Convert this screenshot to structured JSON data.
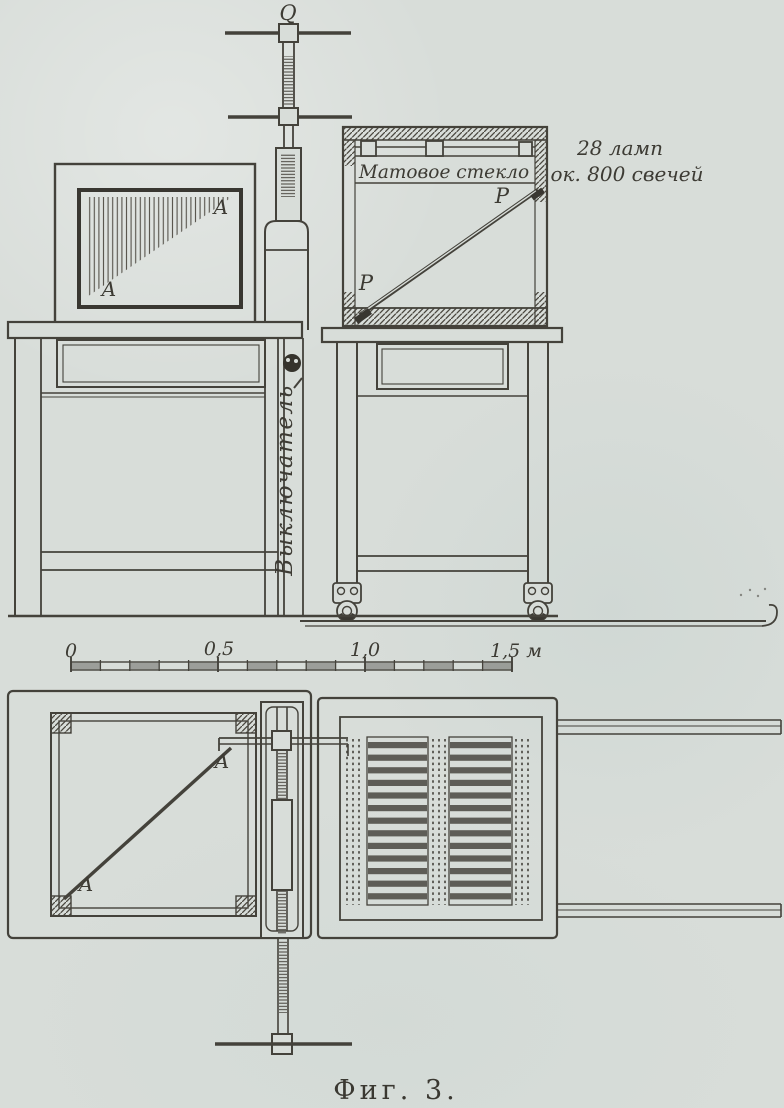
{
  "figure": {
    "caption": "Фиг. 3.",
    "description": "Scanned technical drawing of a photometric lamp-bank apparatus: side elevation (top), scale bar, and plan view (bottom)"
  },
  "annotations": {
    "screw_label": "Q",
    "screen_label_top": "A",
    "screen_label_bottom": "A",
    "rod_label_top": "P",
    "rod_label_bottom": "P",
    "frosted_glass": "Матовое стекло",
    "lamps_note_line1": "28 ламп",
    "lamps_note_line2": "ок. 800 свечей",
    "switch_label": "Выключатель",
    "plan_label_top": "A",
    "plan_label_bottom": "A"
  },
  "scale_bar": {
    "tick_labels": [
      "0",
      "0,5",
      "1,0",
      "1,5 м"
    ],
    "unit": "м",
    "length_meters": 1.5
  },
  "colors": {
    "paper": "#d8ddd9",
    "ink": "#44423b",
    "ink_dark": "#393731"
  }
}
